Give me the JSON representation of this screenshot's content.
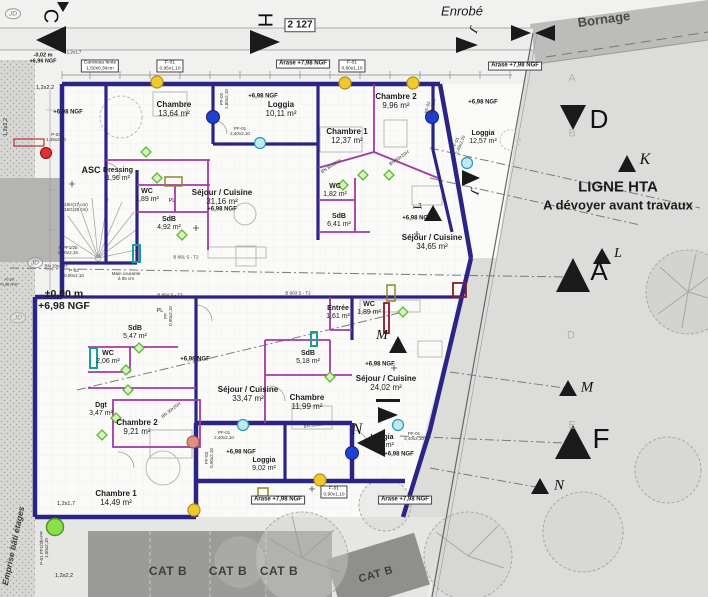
{
  "site": {
    "enrobe": "Enrobé",
    "bornage": "Bornage",
    "dim_top": "2 127",
    "hta1": "LIGNE HTA",
    "hta2": "A dévoyer avant travaux",
    "emprise": "Emprise bâti étages",
    "catb": "CAT B"
  },
  "markers": {
    "c": "C",
    "h": "H",
    "j": "J",
    "d": "D",
    "k": "K",
    "l": "L",
    "a": "A",
    "m": "M",
    "f": "F",
    "n": "N",
    "jd": "JD",
    "grid_a": "A",
    "grid_b": "B",
    "grid_d": "D",
    "grid_e": "E"
  },
  "levels": {
    "arase": "Arase +7,98 NGF",
    "ngf": "+6,98 NGF",
    "zero1": "±0,00 m",
    "zero2": "+6,98 NGF",
    "neg1": "-0,02 m",
    "neg2": "+6,96 NGF",
    "small1": "+0,00",
    "small2": "+6,98 NGF"
  },
  "annotations": {
    "caniveau1": "Caniveau fente",
    "caniveau2": "1,50x0,30cm",
    "asc": "ASC",
    "pl": "PL",
    "stairs1": "16H(17 cm)",
    "stairs2": "15G(28 cm)",
    "mc1": "Main courante",
    "mc2": "à 95 cm",
    "bn80": "BN 80x20H",
    "bn50": "BN 50x20H",
    "bn30": "BN 30x20H",
    "bn20": "BN 20x20H",
    "code1": "B 891 S - T2",
    "code2": "B 894 S - T3",
    "code3": "B 903 S - T2"
  },
  "openings": {
    "f01": "F-01",
    "f01a_size": "0,95x1,10",
    "f01b_size": "0,80x1,10",
    "f01c_size": "0,90x1,10",
    "pf01": "PF-01",
    "pf01_size": "2,40x2,10",
    "pf02": "PF-02",
    "pf02_size": "1,80x2,10",
    "pf03": "PF-03",
    "pf03_size": "0,90x2,10",
    "p01": "P-01 PF1/2b+FP",
    "p01_size": "1,50x2,10",
    "p02": "P-02",
    "p02_size": "0,90x2,10",
    "p03": "P-03",
    "p03_size": "1,36x2,10",
    "ppf": "P-PF1/2b",
    "ppf_size": "0,90x2,15",
    "pp": "PP",
    "pp_size": "0,90x2,10",
    "w1": "1,2x2,2",
    "w2": "1,2x1,7"
  },
  "apartments": {
    "a1": {
      "chambre": "Chambre",
      "chambre_a": "13,64 m²",
      "dressing": "Dressing",
      "dressing_a": "1,96 m²",
      "wc": "WC",
      "wc_a": "1,89 m²",
      "sdb": "SdB",
      "sdb_a": "4,92 m²",
      "sejour": "Séjour / Cuisine",
      "sejour_a": "31,16 m²",
      "loggia": "Loggia",
      "loggia_a": "10,11 m²"
    },
    "a2": {
      "ch1": "Chambre 1",
      "ch1_a": "12,37 m²",
      "ch2": "Chambre 2",
      "ch2_a": "9,96 m²",
      "wc": "WC",
      "wc_a": "1,82 m²",
      "sdb": "SdB",
      "sdb_a": "6,41 m²",
      "sejour": "Séjour / Cuisine",
      "sejour_a": "34,65 m²",
      "loggia": "Loggia",
      "loggia_a": "12,57 m²"
    },
    "a3": {
      "sdb": "SdB",
      "sdb_a": "5,47 m²",
      "wc": "WC",
      "wc_a": "2,06 m²",
      "dgt": "Dgt",
      "dgt_a": "3,47 m²",
      "ch2": "Chambre 2",
      "ch2_a": "9,21 m²",
      "ch1": "Chambre 1",
      "ch1_a": "14,49 m²",
      "sejour": "Séjour / Cuisine",
      "sejour_a": "33,47 m²",
      "loggia": "Loggia",
      "loggia_a": "9,02 m²"
    },
    "a4": {
      "entree": "Entrée",
      "entree_a": "1,61 m²",
      "wc": "WC",
      "wc_a": "1,89 m²",
      "sdb": "SdB",
      "sdb_a": "5,18 m²",
      "chambre": "Chambre",
      "chambre_a": "11,99 m²",
      "sejour": "Séjour / Cuisine",
      "sejour_a": "24,02 m²",
      "loggia": "Loggia",
      "loggia_a": "7,42 m²"
    }
  },
  "colors": {
    "wall": "#2c2484",
    "partition": "#a23aa2",
    "teal": "#18a096",
    "site_gray": "#dcdcda"
  }
}
